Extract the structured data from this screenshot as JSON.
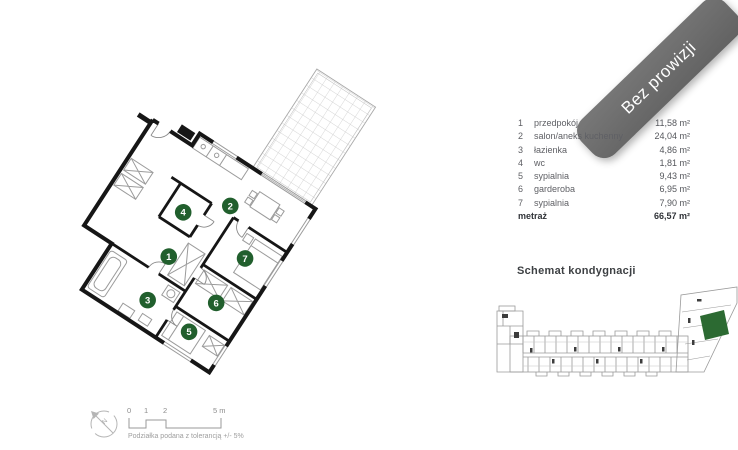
{
  "banner": {
    "text": "Bez prowizji",
    "color": "#6b6b6b"
  },
  "legend": {
    "rooms": [
      {
        "no": "1",
        "name": "przedpokój",
        "area": "11,58 m²"
      },
      {
        "no": "2",
        "name": "salon/aneks kuchenny",
        "area": "24,04 m²"
      },
      {
        "no": "3",
        "name": "łazienka",
        "area": "4,86 m²"
      },
      {
        "no": "4",
        "name": "wc",
        "area": "1,81 m²"
      },
      {
        "no": "5",
        "name": "sypialnia",
        "area": "9,43 m²"
      },
      {
        "no": "6",
        "name": "garderoba",
        "area": "6,95 m²"
      },
      {
        "no": "7",
        "name": "sypialnia",
        "area": "7,90 m²"
      }
    ],
    "total_label": "metraż",
    "total_area": "66,57 m²"
  },
  "floor_plan": {
    "room_numbers": [
      "1",
      "2",
      "3",
      "4",
      "5",
      "6",
      "7"
    ],
    "circle_color": "#215f2d"
  },
  "schematic": {
    "title": "Schemat kondygnacji",
    "highlight_color": "#2c6a32"
  },
  "scale_bar": {
    "ticks": [
      "0",
      "1",
      "2",
      "5 m"
    ],
    "note": "Podziałka podana z tolerancją +/- 5%",
    "north_label": "N"
  }
}
